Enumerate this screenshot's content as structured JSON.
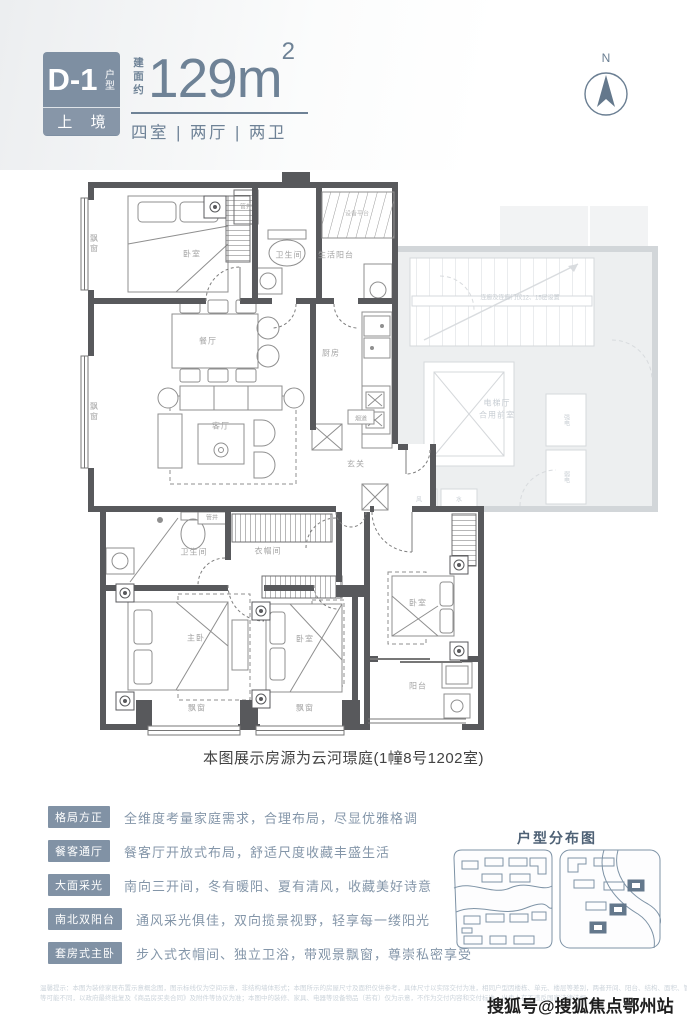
{
  "header": {
    "badge_code": "D-1",
    "badge_code_label": "户型",
    "badge_sub": "上 境",
    "area_prefix": "建面约",
    "area_number": "129m",
    "area_sup": "2",
    "layout_text": "四室 | 两厅 | 两卫",
    "compass_n": "N"
  },
  "plan": {
    "caption": "本图展示房源为云河璟庭(1幢8号1202室)",
    "labels": [
      {
        "id": "bedroom-tl",
        "text": "卧室"
      },
      {
        "id": "bay-window-left-1",
        "text": "飘窗"
      },
      {
        "id": "bath-1",
        "text": "卫生间"
      },
      {
        "id": "service-balcony",
        "text": "生活阳台"
      },
      {
        "id": "equipment-platform",
        "text": "设备平台"
      },
      {
        "id": "pipe-shaft-1",
        "text": "管井"
      },
      {
        "id": "dining",
        "text": "餐厅"
      },
      {
        "id": "kitchen",
        "text": "厨房"
      },
      {
        "id": "bay-window-left-2",
        "text": "飘窗"
      },
      {
        "id": "living",
        "text": "客厅"
      },
      {
        "id": "flue",
        "text": "烟道"
      },
      {
        "id": "foyer",
        "text": "玄关"
      },
      {
        "id": "pipe-shaft-2",
        "text": "管井"
      },
      {
        "id": "bath-2",
        "text": "卫生间"
      },
      {
        "id": "closet",
        "text": "衣帽间"
      },
      {
        "id": "master-bedroom",
        "text": "主卧"
      },
      {
        "id": "bedroom-2",
        "text": "卧室"
      },
      {
        "id": "bedroom-3",
        "text": "卧室"
      },
      {
        "id": "balcony",
        "text": "阳台"
      },
      {
        "id": "bay-window-bottom-1",
        "text": "飘窗"
      },
      {
        "id": "bay-window-bottom-2",
        "text": "飘窗"
      },
      {
        "id": "elevator-hall",
        "text": "电梯厅"
      },
      {
        "id": "shared-front-room",
        "text": "合用前室"
      },
      {
        "id": "strong-electric",
        "text": "强电"
      },
      {
        "id": "weak-electric",
        "text": "弱电"
      },
      {
        "id": "wind-shaft",
        "text": "风"
      },
      {
        "id": "water-shaft",
        "text": "水"
      },
      {
        "id": "corridor-note",
        "text": "连廊及连廊门仅12、15层设置"
      }
    ]
  },
  "features": [
    {
      "tag": "格局方正",
      "desc": "全维度考量家庭需求，合理布局，尽显优雅格调"
    },
    {
      "tag": "餐客通厅",
      "desc": "餐客厅开放式布局，舒适尺度收藏丰盛生活"
    },
    {
      "tag": "大面采光",
      "desc": "南向三开间，冬有暖阳、夏有清风，收藏美好诗意"
    },
    {
      "tag": "南北双阳台",
      "desc": "通风采光俱佳，双向揽景视野，轻享每一缕阳光"
    },
    {
      "tag": "套房式主卧",
      "desc": "步入式衣帽间、独立卫浴，带观景飘窗，尊崇私密享受"
    }
  ],
  "distribution": {
    "title": "户型分布图"
  },
  "disclaimer": {
    "line1": "温馨提示：本图为装修家居布置示意概念图，图示标线仅为空间示意，非结构墙体形式；本图所示的房屋尺寸及面积仅供参考，具体尺寸以实际交付为准，相同户型因楼栋、单元、楼层等差别，两者开间、阳台、结构、面积、管道位置、外立面、设备平台",
    "line2": "等可能不同，以政府最终批复及《商品房买卖合同》及附件等协议为准；本图中的装修、家具、电器等设备物品（若有）仅为示意，不作为交付内容和交付标准。出卖人在不违反国家法律法规…"
  },
  "watermark": "搜狐号@搜狐焦点鄂州站",
  "colors": {
    "accent_slate": "#7e8fa2",
    "title_slate": "#6e8296",
    "plan_wall": "#58595c",
    "gray_common": "#edeff0",
    "feature_tag": "#8192a5",
    "feature_text": "#8496a9",
    "disclaimer_text": "#ccd4db"
  }
}
